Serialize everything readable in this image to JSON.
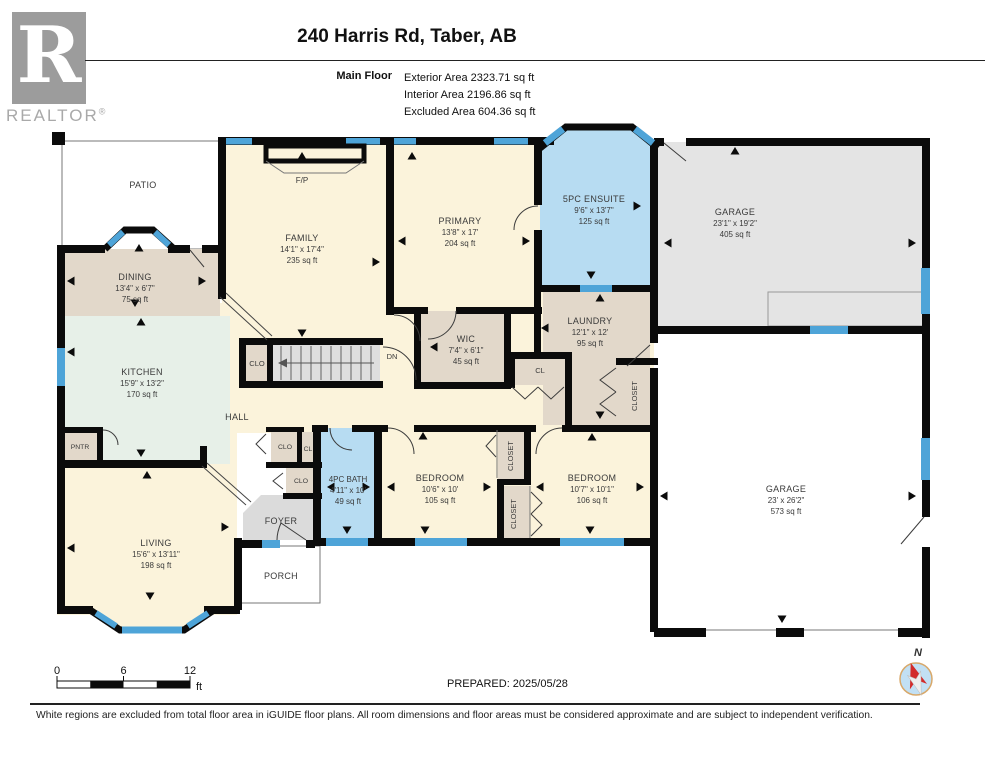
{
  "header": {
    "logo_letter": "R",
    "logo_brand": "REALTOR",
    "logo_reg": "®",
    "title": "240 Harris Rd, Taber, AB",
    "floor_label": "Main Floor",
    "area_exterior": "Exterior Area 2323.71 sq ft",
    "area_interior": "Interior Area 2196.86 sq ft",
    "area_excluded": "Excluded Area 604.36 sq ft"
  },
  "rooms": {
    "patio": {
      "name": "PATIO"
    },
    "dining": {
      "name": "DINING",
      "dims": "13'4\" x 6'7\"",
      "area": "75 sq ft"
    },
    "family": {
      "name": "FAMILY",
      "dims": "14'1\" x 17'4\"",
      "area": "235 sq ft"
    },
    "fireplace": {
      "name": "F/P"
    },
    "primary": {
      "name": "PRIMARY",
      "dims": "13'8\" x 17'",
      "area": "204 sq ft"
    },
    "ensuite": {
      "name": "5PC ENSUITE",
      "dims": "9'6\" x 13'7\"",
      "area": "125 sq ft"
    },
    "garage_upper": {
      "name": "GARAGE",
      "dims": "23'1\" x 19'2\"",
      "area": "405 sq ft"
    },
    "wic": {
      "name": "WIC",
      "dims": "7'4\" x 6'1\"",
      "area": "45 sq ft"
    },
    "laundry": {
      "name": "LAUNDRY",
      "dims": "12'1\" x 12'",
      "area": "95 sq ft"
    },
    "kitchen": {
      "name": "KITCHEN",
      "dims": "15'9\" x 13'2\"",
      "area": "170 sq ft"
    },
    "hall": {
      "name": "HALL"
    },
    "pantry": {
      "name": "PNTR"
    },
    "stair_closet": {
      "name": "CLO"
    },
    "down": {
      "name": "DN"
    },
    "closet_a": {
      "name": "CLO"
    },
    "closet_b": {
      "name": "CL"
    },
    "closet_c": {
      "name": "CLO"
    },
    "laundry_cl": {
      "name": "CL"
    },
    "laundry_closet": {
      "name": "CLOSET"
    },
    "bath": {
      "name": "4PC BATH",
      "dims": "4'11\" x 10'",
      "area": "49 sq ft"
    },
    "bedroom1": {
      "name": "BEDROOM",
      "dims": "10'6\" x 10'",
      "area": "105 sq ft"
    },
    "closet1": {
      "name": "CLOSET"
    },
    "closet2": {
      "name": "CLOSET"
    },
    "bedroom2": {
      "name": "BEDROOM",
      "dims": "10'7\" x 10'1\"",
      "area": "106 sq ft"
    },
    "living": {
      "name": "LIVING",
      "dims": "15'6\" x 13'11\"",
      "area": "198 sq ft"
    },
    "foyer": {
      "name": "FOYER"
    },
    "porch": {
      "name": "PORCH"
    },
    "garage_lower": {
      "name": "GARAGE",
      "dims": "23' x 26'2\"",
      "area": "573 sq ft"
    }
  },
  "footer": {
    "scale": {
      "t0": "0",
      "t6": "6",
      "t12": "12",
      "unit": "ft"
    },
    "prepared": "PREPARED: 2025/05/28",
    "compass_n": "N",
    "disclaimer": "White regions are excluded from total floor area in iGUIDE floor plans. All room dimensions and floor areas must be considered approximate and are subject to independent verification."
  },
  "colors": {
    "wall": "#0b0b0b",
    "window_blue": "#4ea4d8",
    "room_cream": "#fbf3db",
    "room_tan": "#e2d8ca",
    "room_mint": "#e7f0e8",
    "room_blue": "#b7dcf2",
    "room_gray": "#e4e4e4",
    "foyer_gray": "#dbdbdb",
    "stairs_gray": "#dedede",
    "logo_gray": "#9c9c9c",
    "compass_ring": "#d8a86a",
    "compass_fill": "#c2e0f4",
    "needle_red": "#d22b2b"
  }
}
